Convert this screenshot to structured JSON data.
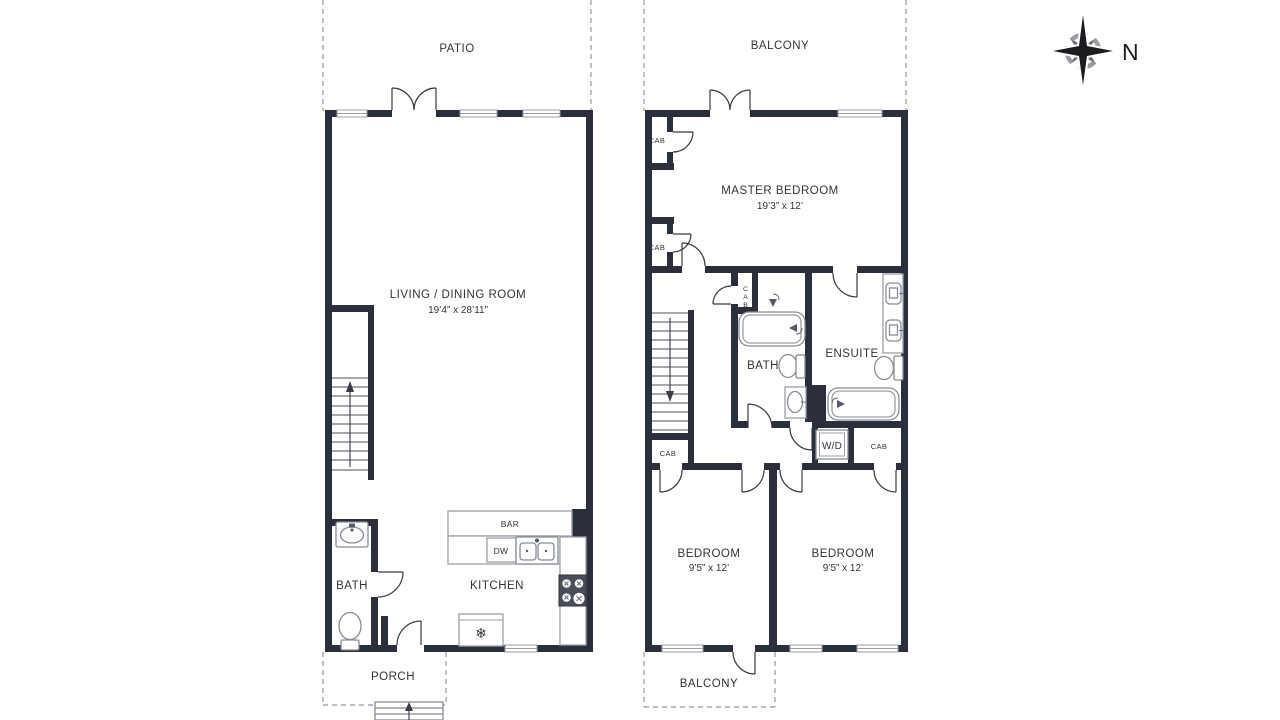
{
  "colors": {
    "wall": "#2b2e3b",
    "text": "#32343c",
    "line": "#383b45",
    "fixture": "#9aa0a8",
    "fixture-dark": "#878c96",
    "dashed": "#a4a7ae",
    "tread": "#70747e",
    "stove": "#4b4e58"
  },
  "compass": {
    "north": "N"
  },
  "icons": {
    "snowflake": "❄"
  },
  "floor1": {
    "patio": "PATIO",
    "living_dining": {
      "name": "LIVING / DINING ROOM",
      "dims": "19’4” x 28’11”"
    },
    "bath": "BATH",
    "kitchen": "KITCHEN",
    "bar": "BAR",
    "dishwasher": "DW",
    "porch": "PORCH"
  },
  "floor2": {
    "balcony_top": "BALCONY",
    "master_bedroom": {
      "name": "MASTER BEDROOM",
      "dims": "19’3” x 12’"
    },
    "cab_closet_top": "CAB",
    "cab_closet_mid": "CAB",
    "cab_tall": [
      "C",
      "A",
      "B"
    ],
    "bath": "BATH",
    "ensuite": "ENSUITE",
    "washer_dryer": "W/D",
    "cab_hall_left": "CAB",
    "cab_hall_right": "CAB",
    "bedroom_left": {
      "name": "BEDROOM",
      "dims": "9’5” x 12’"
    },
    "bedroom_right": {
      "name": "BEDROOM",
      "dims": "9’5” x 12’"
    },
    "balcony_bottom": "BALCONY"
  }
}
